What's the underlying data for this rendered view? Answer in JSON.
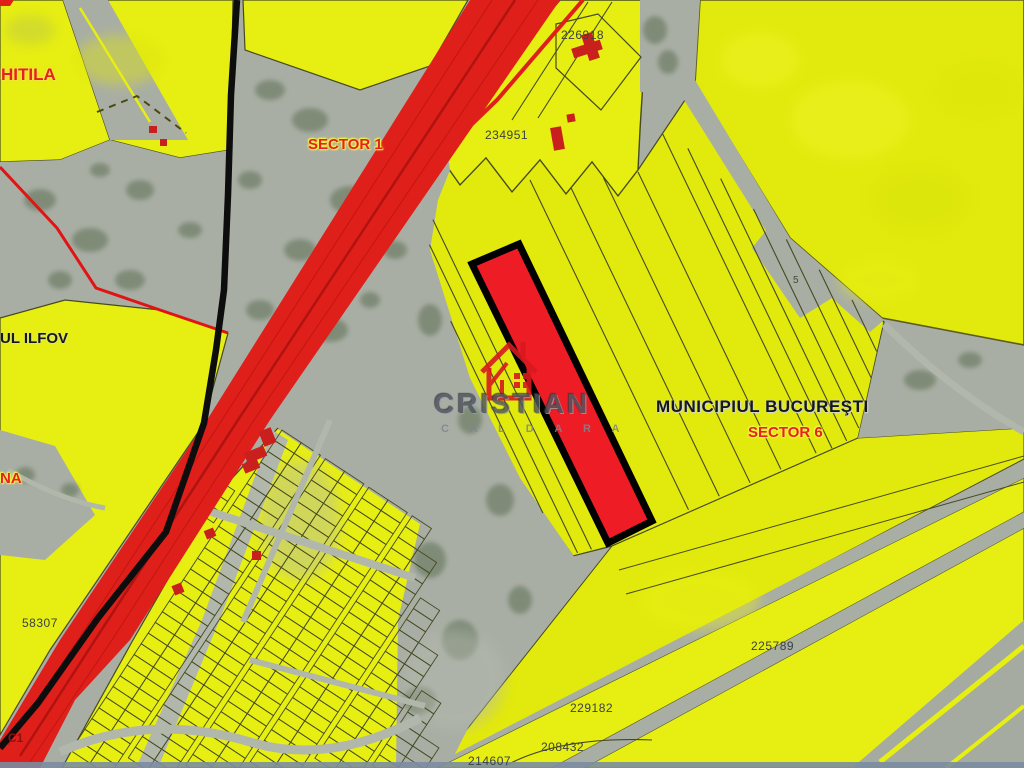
{
  "map": {
    "labels": [
      {
        "id": "locality-chitila",
        "text": "HITILA",
        "x": 1,
        "y": 66,
        "style": "red-lg"
      },
      {
        "id": "sector-1",
        "text": "SECTOR 1",
        "x": 308,
        "y": 137,
        "style": "red"
      },
      {
        "id": "judetul-ilfov",
        "text": "UL ILFOV",
        "x": 0,
        "y": 331,
        "style": "black"
      },
      {
        "id": "locality-na",
        "text": "NA",
        "x": 0,
        "y": 471,
        "style": "red"
      },
      {
        "id": "municipiul-bucuresti",
        "text": "MUNICIPIUL BUCUREŞTI",
        "x": 656,
        "y": 398,
        "style": "black-lg"
      },
      {
        "id": "sector-6",
        "text": "SECTOR 6",
        "x": 748,
        "y": 425,
        "style": "red"
      },
      {
        "id": "road-c1",
        "text": "C1",
        "x": 8,
        "y": 732,
        "style": "c1"
      },
      {
        "id": "cad-226918",
        "text": "226918",
        "x": 561,
        "y": 29,
        "style": "num"
      },
      {
        "id": "cad-234951",
        "text": "234951",
        "x": 485,
        "y": 129,
        "style": "num"
      },
      {
        "id": "cad-58307",
        "text": "58307",
        "x": 22,
        "y": 617,
        "style": "num"
      },
      {
        "id": "cad-225789",
        "text": "225789",
        "x": 751,
        "y": 640,
        "style": "num"
      },
      {
        "id": "cad-229182",
        "text": "229182",
        "x": 570,
        "y": 702,
        "style": "num"
      },
      {
        "id": "cad-208432",
        "text": "208432",
        "x": 541,
        "y": 741,
        "style": "num"
      },
      {
        "id": "cad-214607",
        "text": "214607",
        "x": 468,
        "y": 755,
        "style": "num"
      },
      {
        "id": "cad-5",
        "text": "5",
        "x": 793,
        "y": 276,
        "style": "num-sm"
      }
    ],
    "buildings": [
      {
        "x": 572,
        "y": 44,
        "w": 30,
        "h": 10,
        "r": -18
      },
      {
        "x": 585,
        "y": 33,
        "w": 11,
        "h": 27,
        "r": -18
      },
      {
        "x": 552,
        "y": 127,
        "w": 11,
        "h": 23,
        "r": -10
      },
      {
        "x": 567,
        "y": 114,
        "w": 8,
        "h": 8,
        "r": -10
      },
      {
        "x": 261,
        "y": 429,
        "w": 13,
        "h": 16,
        "r": -22
      },
      {
        "x": 245,
        "y": 449,
        "w": 21,
        "h": 11,
        "r": -22
      },
      {
        "x": 243,
        "y": 461,
        "w": 16,
        "h": 10,
        "r": -22
      },
      {
        "x": 205,
        "y": 529,
        "w": 10,
        "h": 9,
        "r": -22
      },
      {
        "x": 252,
        "y": 551,
        "w": 9,
        "h": 9,
        "r": 0
      },
      {
        "x": 173,
        "y": 584,
        "w": 10,
        "h": 10,
        "r": -22
      },
      {
        "x": 149,
        "y": 126,
        "w": 8,
        "h": 7,
        "r": 0
      },
      {
        "x": 160,
        "y": 139,
        "w": 7,
        "h": 7,
        "r": 0
      }
    ],
    "highlighted_parcel": {
      "fill": "#ee1c25",
      "outline": "#000000"
    },
    "colors": {
      "yellow": "#e7ee12",
      "yellow_deep": "#e2e90c",
      "gray": "#a9aea4",
      "road_gray": "#b2b7ac",
      "red": "#df1f1a",
      "red_median": "#b01310",
      "parcel_red": "#ee1c25",
      "black": "#0d0d0d",
      "line_olive": "#454a20",
      "building_red": "#c9201d",
      "water_blue": "#7b8ca2",
      "tree_green": "#5d7054"
    }
  },
  "watermark": {
    "brand": "CRISTIAN",
    "sub": "C A L D A R A",
    "icon": "house-icon"
  }
}
